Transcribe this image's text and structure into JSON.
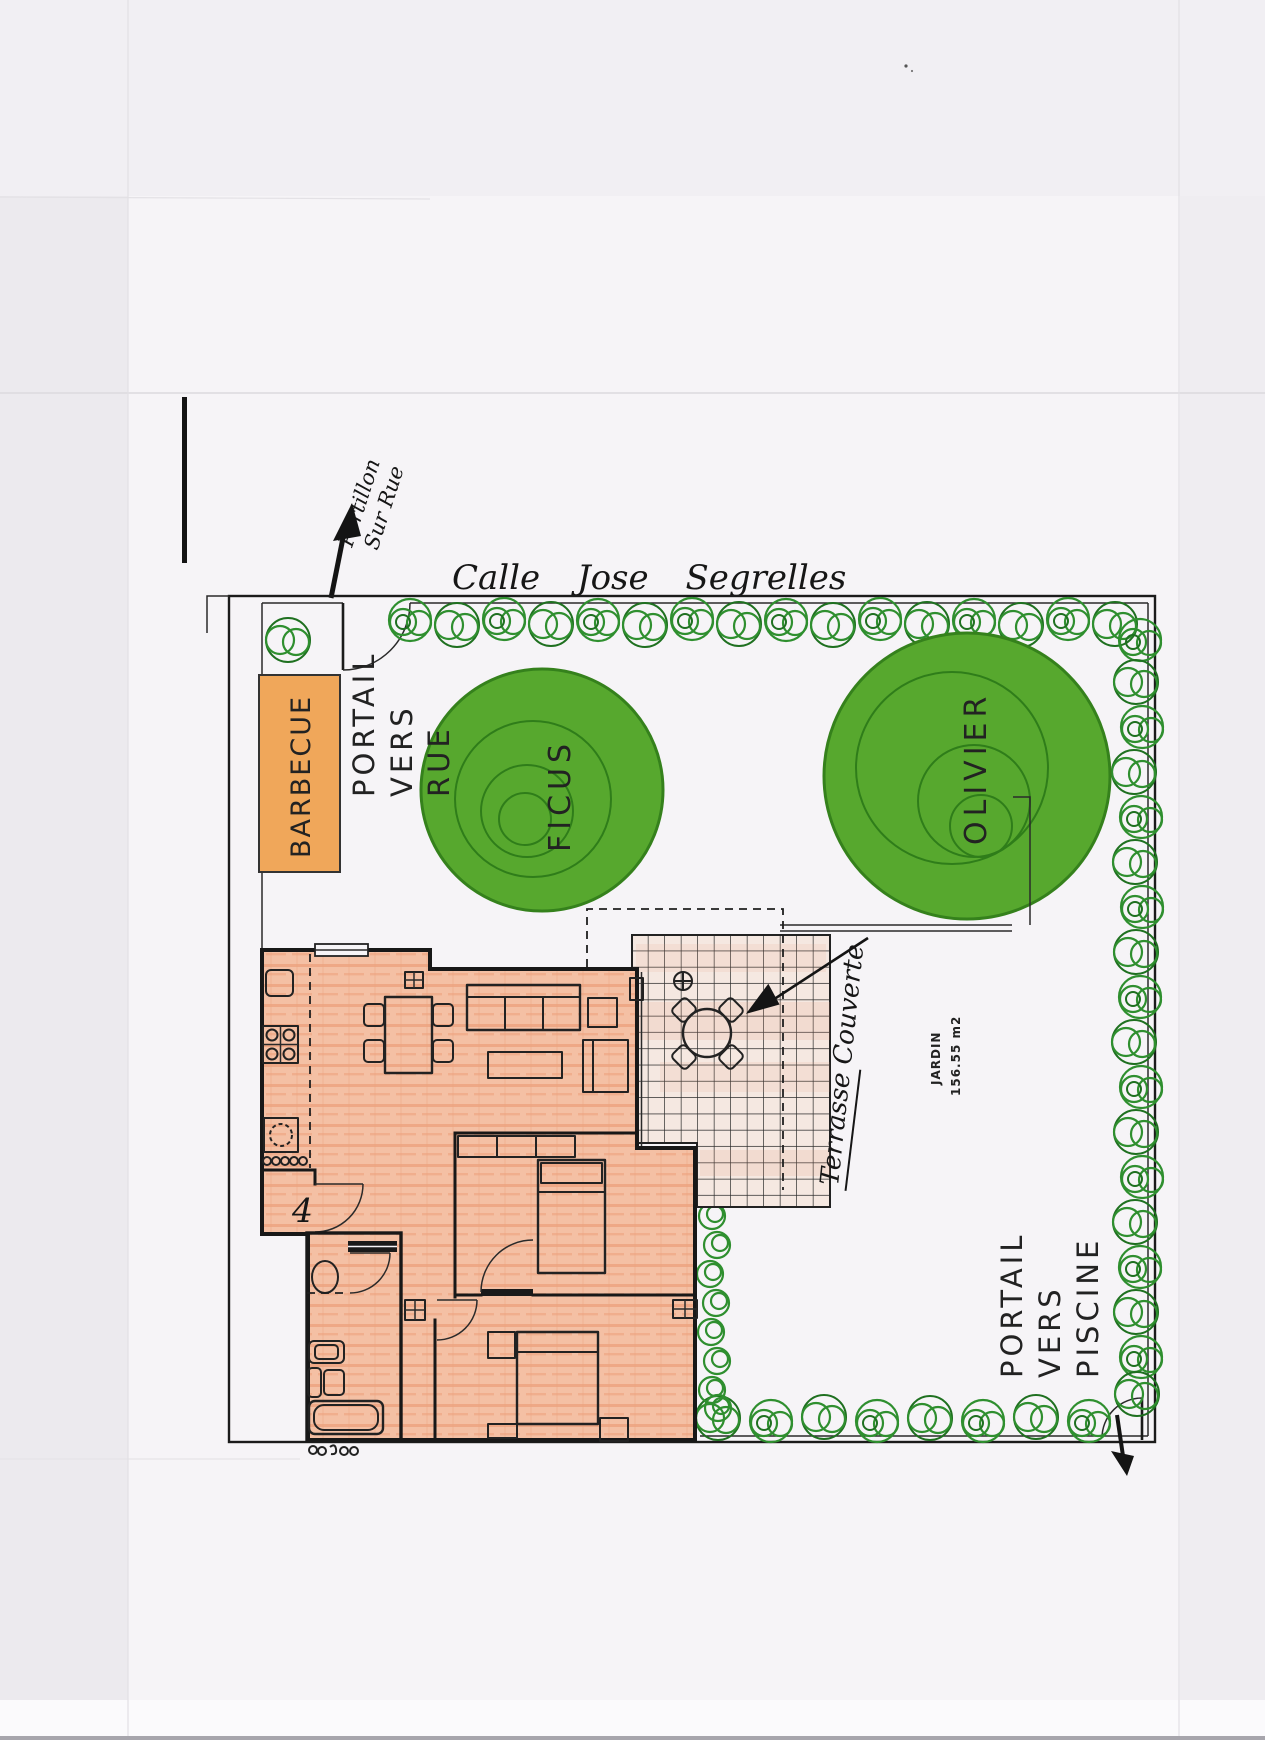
{
  "plan": {
    "street_label": "Calle Jose Segrelles",
    "gate_note": {
      "line1": "Portillon",
      "line2": "Sur Rue"
    },
    "labels": {
      "barbecue": "BARBECUE",
      "portal_street": {
        "l1": "PORTAIL",
        "l2": "VERS",
        "l3": "RUE"
      },
      "portal_pool": {
        "l1": "PORTAIL",
        "l2": "VERS",
        "l3": "PISCINE"
      },
      "tree_ficus": "FICUS",
      "tree_olivier": "OLIVIER",
      "garden_name": "JARDIN",
      "garden_area": "156.55 m2",
      "terrace_note": "Terrasse Couverte",
      "hall_mark": "4"
    },
    "colors": {
      "tree_fill": "#57a82e",
      "tree_stroke": "#35811c",
      "hedge_green": "#2f8f2f",
      "barbecue_fill": "#f0a75a",
      "house_fill": "#f4bfa4",
      "house_crayon": "#e08a64",
      "terrace_fill": "#f5e8e1",
      "ink": "#1c1c1c"
    }
  }
}
